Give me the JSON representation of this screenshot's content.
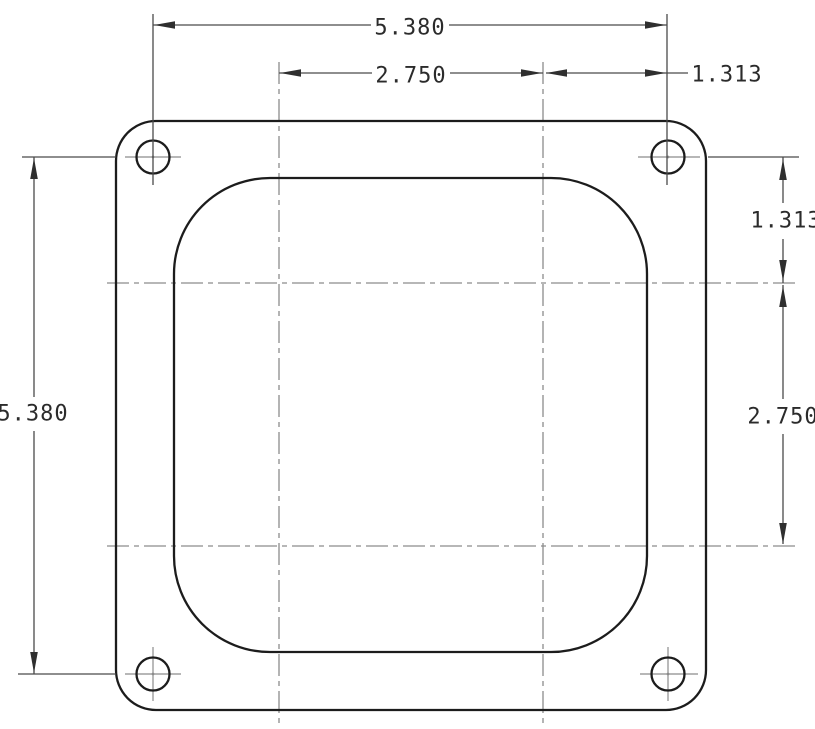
{
  "drawing": {
    "type": "technical-dimension-drawing",
    "part": "square flange plate with four bolt holes and rounded-square opening",
    "dimensions": {
      "top_width": "5.380",
      "top_bore_spacing": "2.750",
      "top_edge_offset": "1.313",
      "right_edge_offset": "1.313",
      "right_bore_spacing": "2.750",
      "left_height": "5.380"
    },
    "colors": {
      "background": "#ffffff",
      "geometry": "#1c1c1c",
      "dimension_lines": "#4a4a4a",
      "centerlines": "#8c8c8c",
      "text": "#2b2b2b"
    }
  }
}
